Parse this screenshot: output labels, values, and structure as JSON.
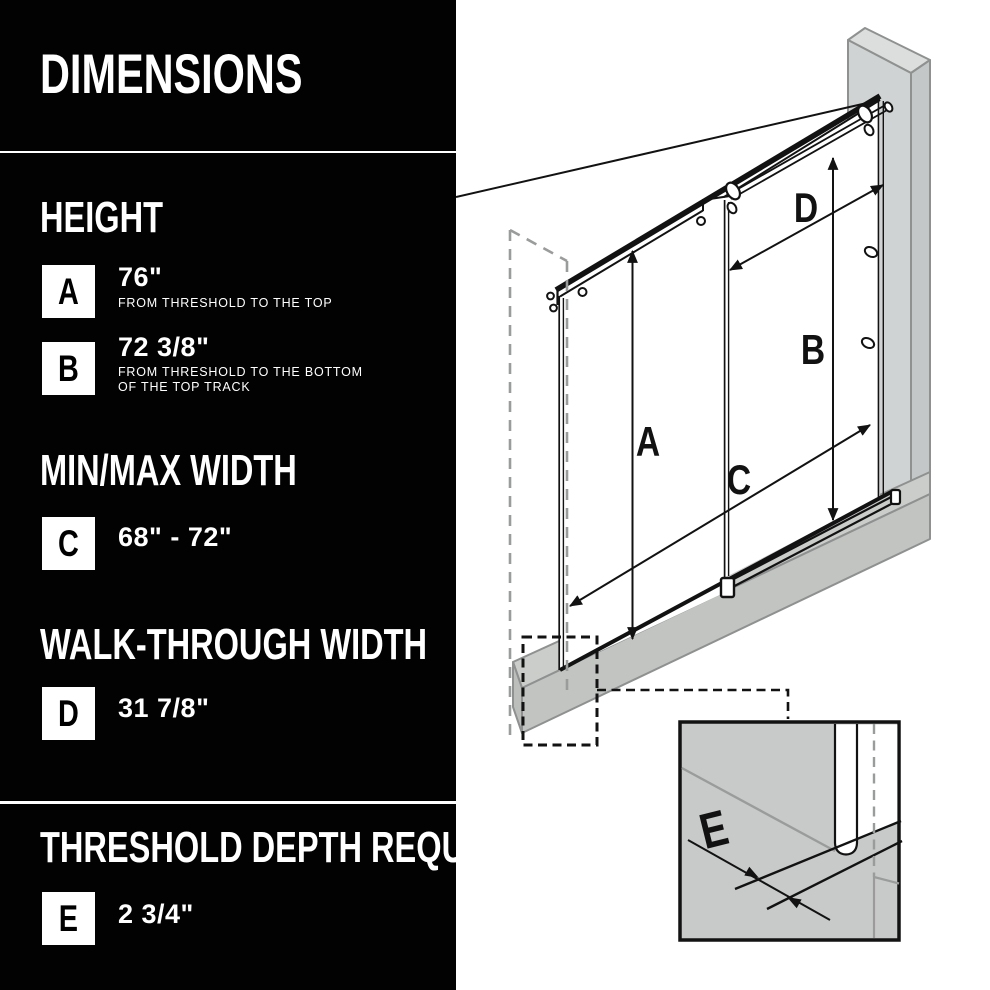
{
  "colors": {
    "panel_bg": "#020202",
    "panel_text": "#ffffff",
    "badge_bg": "#ffffff",
    "badge_text": "#000000",
    "line_black": "#121212",
    "wall_front_gray": "#d0d3d3",
    "wall_side_gray": "#c4c7c7",
    "wall_top_gray": "#dcdede",
    "threshold_top_gray": "#cbcdcb",
    "threshold_front_gray": "#c2c4c2",
    "inset_bg_gray": "#c8cac9",
    "outline_gray": "#8f9191",
    "dashed_gray": "#9a9c9b"
  },
  "panel": {
    "title": "DIMENSIONS",
    "sections": {
      "height": {
        "header": "HEIGHT",
        "rows": {
          "a": {
            "letter": "A",
            "value": "76\"",
            "caption": "FROM THRESHOLD TO THE TOP"
          },
          "b": {
            "letter": "B",
            "value": "72 3/8\"",
            "caption_line1": "FROM THRESHOLD TO THE BOTTOM",
            "caption_line2": "OF THE TOP TRACK"
          }
        }
      },
      "minmax": {
        "header": "MIN/MAX WIDTH",
        "rows": {
          "c": {
            "letter": "C",
            "value": "68\" - 72\""
          }
        }
      },
      "walkthrough": {
        "header": "WALK-THROUGH WIDTH",
        "rows": {
          "d": {
            "letter": "D",
            "value": "31 7/8\""
          }
        }
      },
      "threshold": {
        "header": "THRESHOLD DEPTH REQUIRED",
        "rows": {
          "e": {
            "letter": "E",
            "value": "2 3/4\""
          }
        }
      }
    }
  },
  "diagram": {
    "labels": {
      "a": "A",
      "b": "B",
      "c": "C",
      "d": "D",
      "e": "E"
    }
  }
}
